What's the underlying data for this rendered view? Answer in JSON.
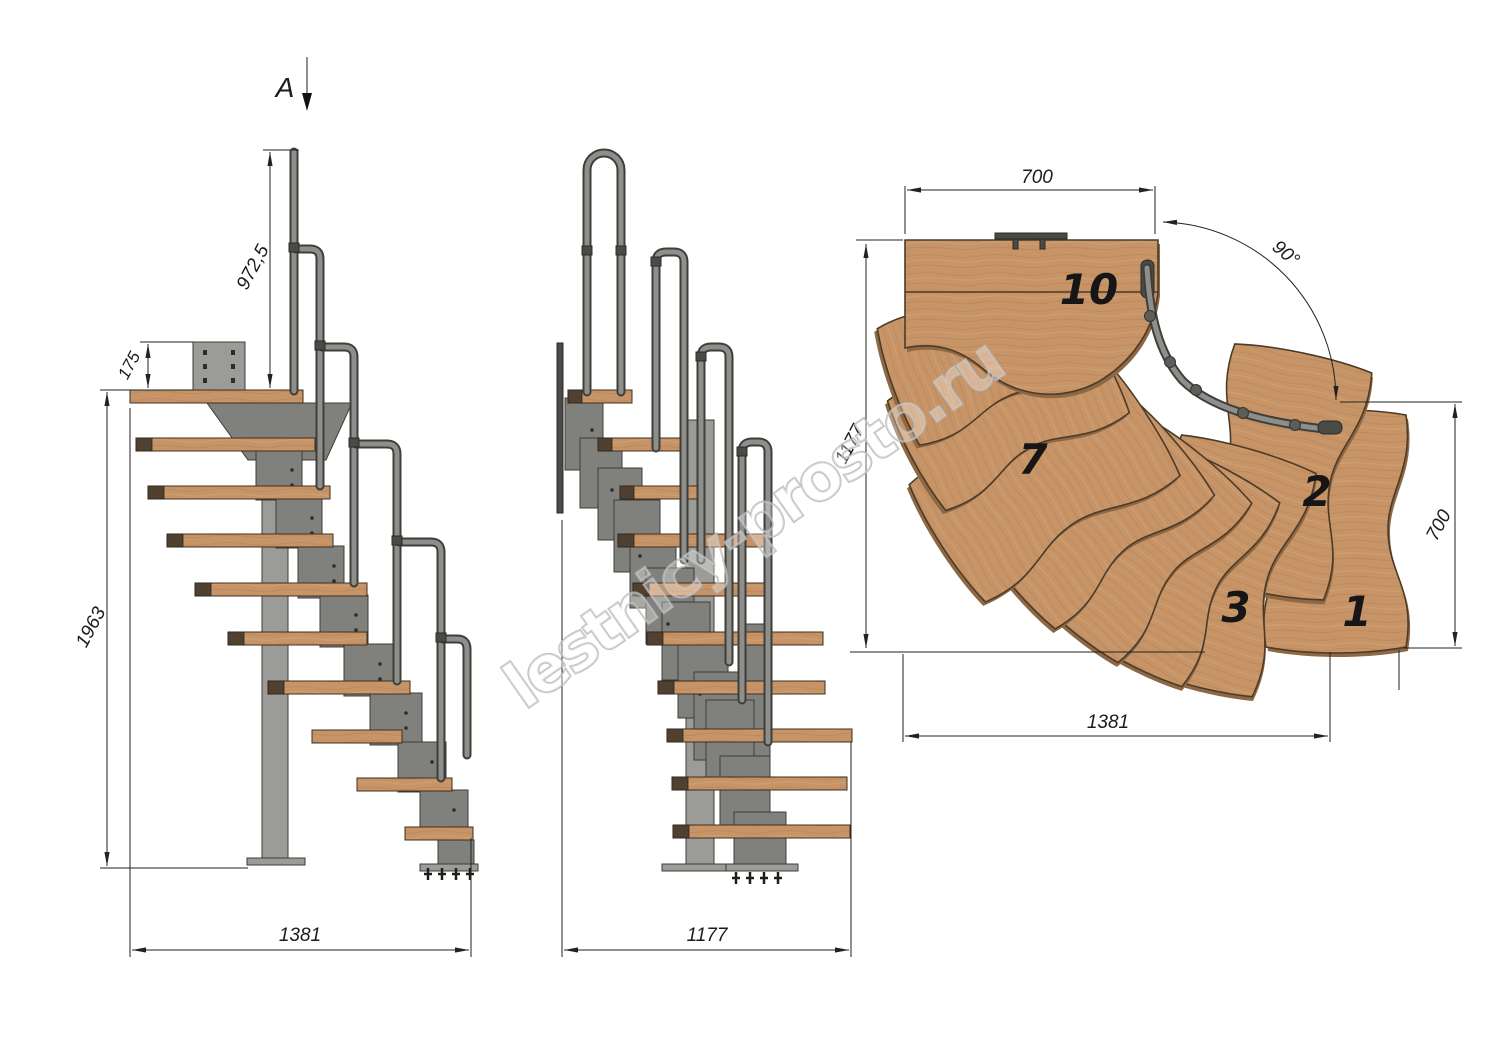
{
  "watermark": {
    "text": "lestnicy-prosto.ru"
  },
  "side_view": {
    "section_label": "A",
    "dim_handrail_height": "972,5",
    "dim_plate_offset": "175",
    "dim_total_rise": "1963",
    "dim_total_run": "1381"
  },
  "front_view": {
    "dim_total_width": "1177"
  },
  "plan_view": {
    "dim_landing_width": "700",
    "dim_turn_angle": "90°",
    "dim_side_depth": "1177",
    "dim_exit_width": "700",
    "dim_total_length": "1381",
    "treads": [
      {
        "label": "10"
      },
      {
        "label": "7"
      },
      {
        "label": "2"
      },
      {
        "label": "3"
      },
      {
        "label": "1"
      }
    ]
  },
  "colors": {
    "wood": "#c69467",
    "wood_edge": "#4d3b27",
    "wood_end_cap": "#50402f",
    "metal": "#80807c",
    "metal_light": "#9b9b97",
    "metal_dark": "#4a4a46",
    "rail": "#8e8e8a",
    "dim_line": "#222222",
    "watermark": "#b3b3b3",
    "background": "#ffffff"
  }
}
